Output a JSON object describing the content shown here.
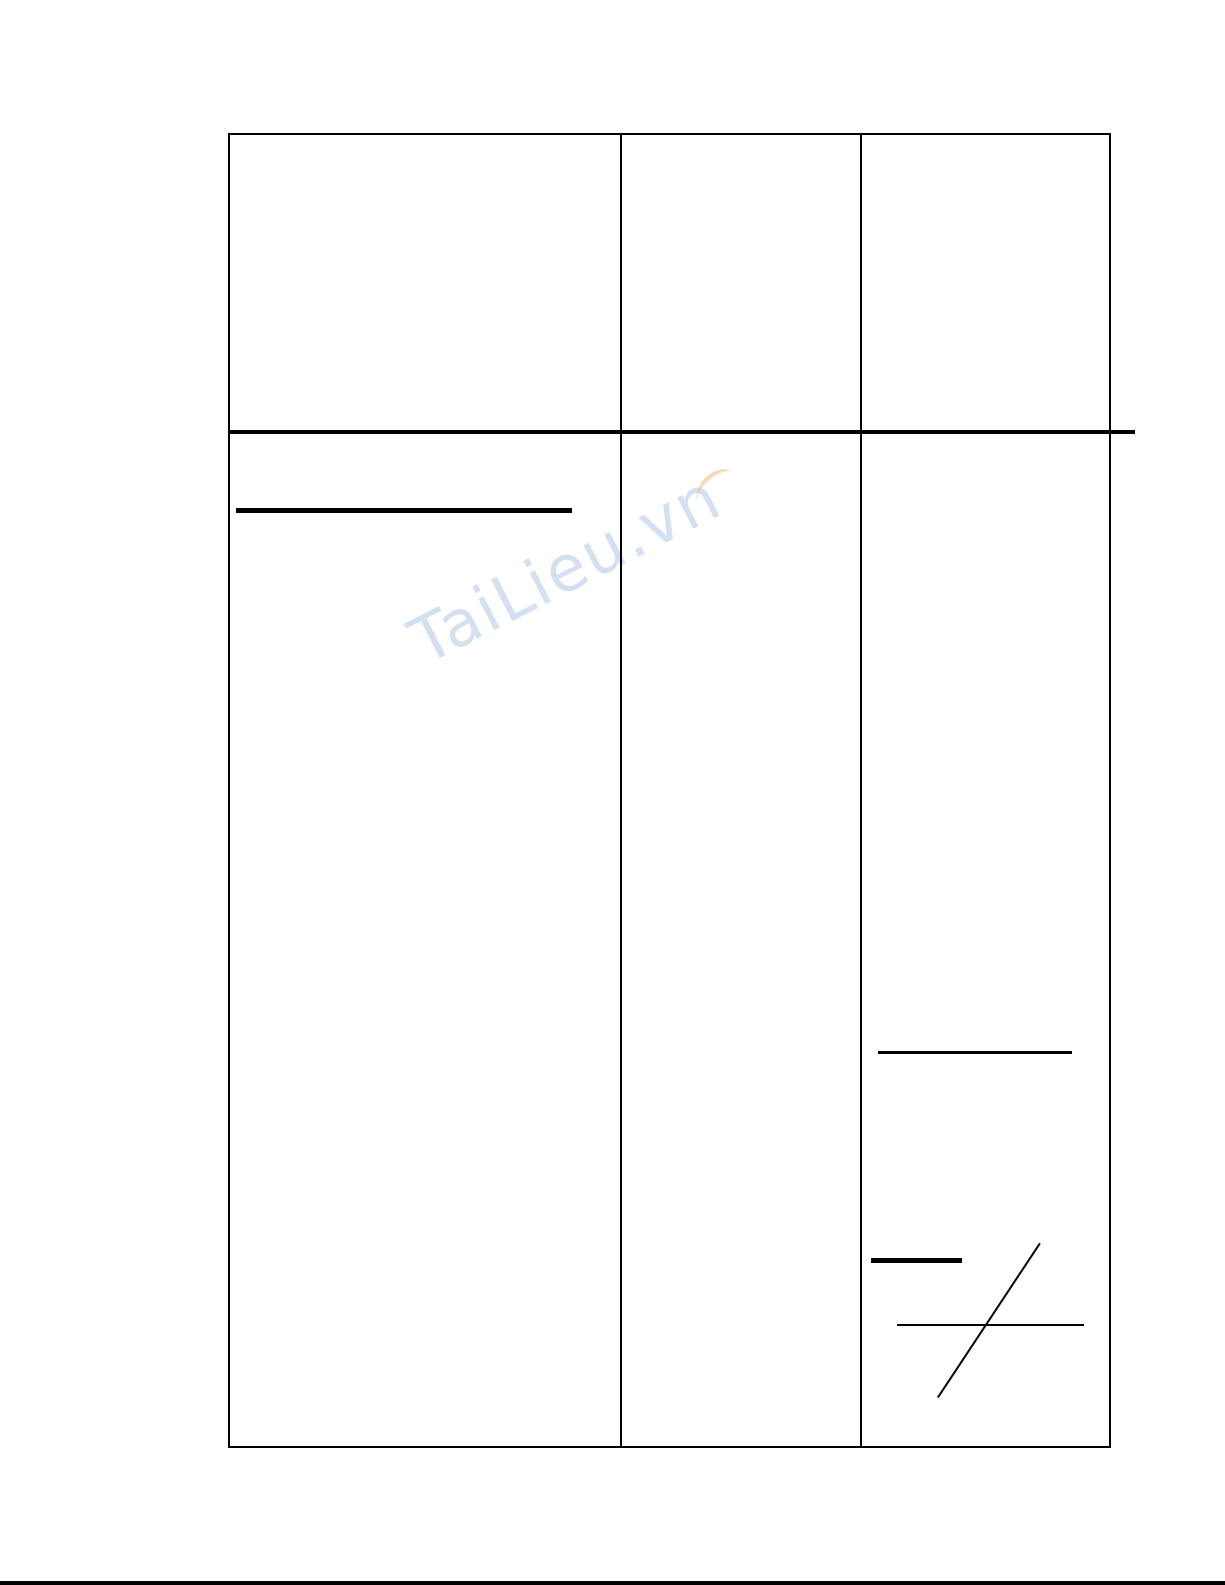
{
  "page": {
    "background_color": "#ffffff",
    "line_color": "#000000"
  },
  "watermark": {
    "text": "TaiLieu.vn",
    "text_color": "#a8c1e0",
    "swoosh_color": "#f5bd7e"
  },
  "table": {
    "columns": 3,
    "rows": 2,
    "cell_text": [
      "",
      "",
      "",
      "",
      "",
      ""
    ]
  }
}
